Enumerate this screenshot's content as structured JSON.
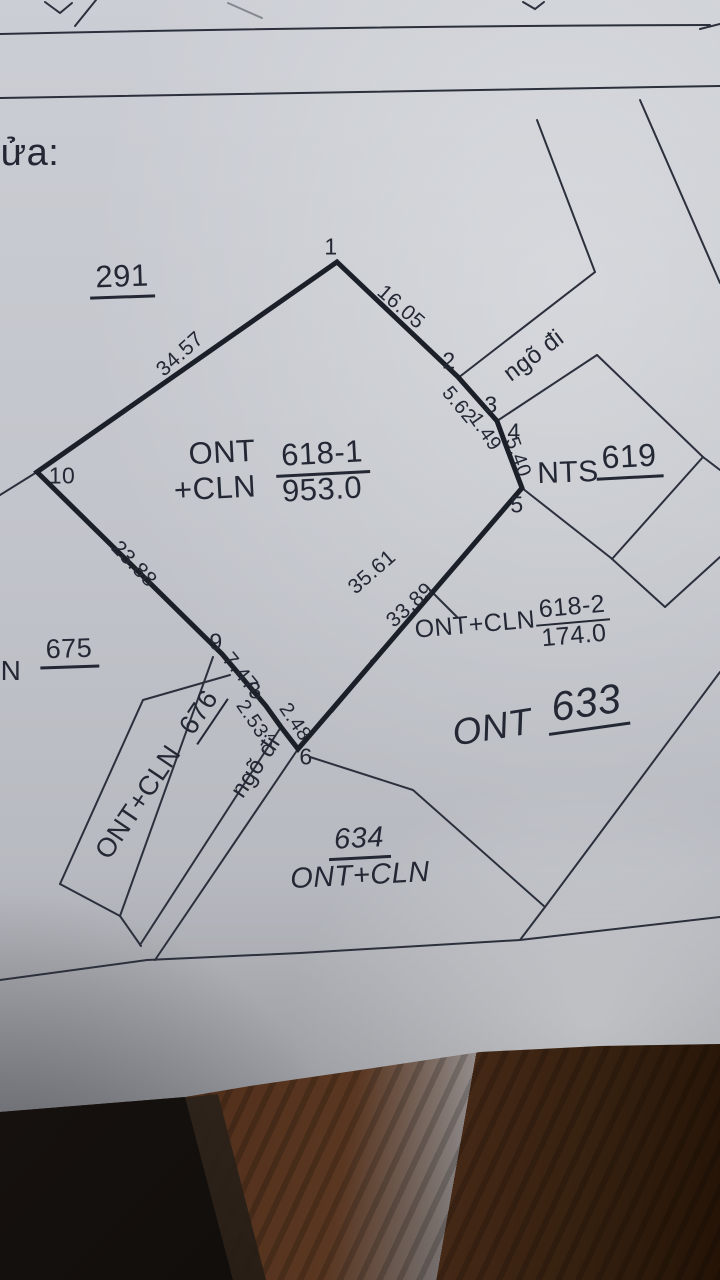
{
  "photo": {
    "header": {
      "partial_text": "ửa:"
    },
    "parcels": {
      "p291": {
        "number": "291"
      },
      "p675": {
        "prefix": "N",
        "number": "675"
      },
      "p676": {
        "type": "ONT+CLN",
        "number": "676"
      },
      "p619": {
        "type": "NTS",
        "number": "619"
      },
      "p618_1": {
        "type_line1": "ONT",
        "number": "618-1",
        "type_line2": "+CLN",
        "area": "953.0"
      },
      "p618_2": {
        "type": "ONT+CLN",
        "number": "618-2",
        "area": "174.0"
      },
      "p633": {
        "type": "ONT",
        "number": "633"
      },
      "p634": {
        "number": "634",
        "type": "ONT+CLN"
      }
    },
    "paths": {
      "top": "ngõ đi",
      "bottom": "ngõ đi"
    },
    "vertices": {
      "v1": "1",
      "v2": "2",
      "v3": "3",
      "v4": "4",
      "v5": "5",
      "v6": "6",
      "v7": "7",
      "v8": "8",
      "v9": "9",
      "v10": "10"
    },
    "edges": {
      "e1_2": "16.05",
      "e2_3": "5.62",
      "e3_4": "1.49",
      "e4_5": "5.40",
      "e5_6": "35.61",
      "e6_7": "2.48",
      "e7_8": "2.53",
      "e8_9": "7.47",
      "e9_10": "23.88",
      "e10_1": "34.57",
      "strip_618_2": "33.89"
    },
    "colors": {
      "ink": "#232834",
      "paper": "#c2c5cb",
      "wood": "#53311c",
      "shadow": "#14100d"
    }
  }
}
